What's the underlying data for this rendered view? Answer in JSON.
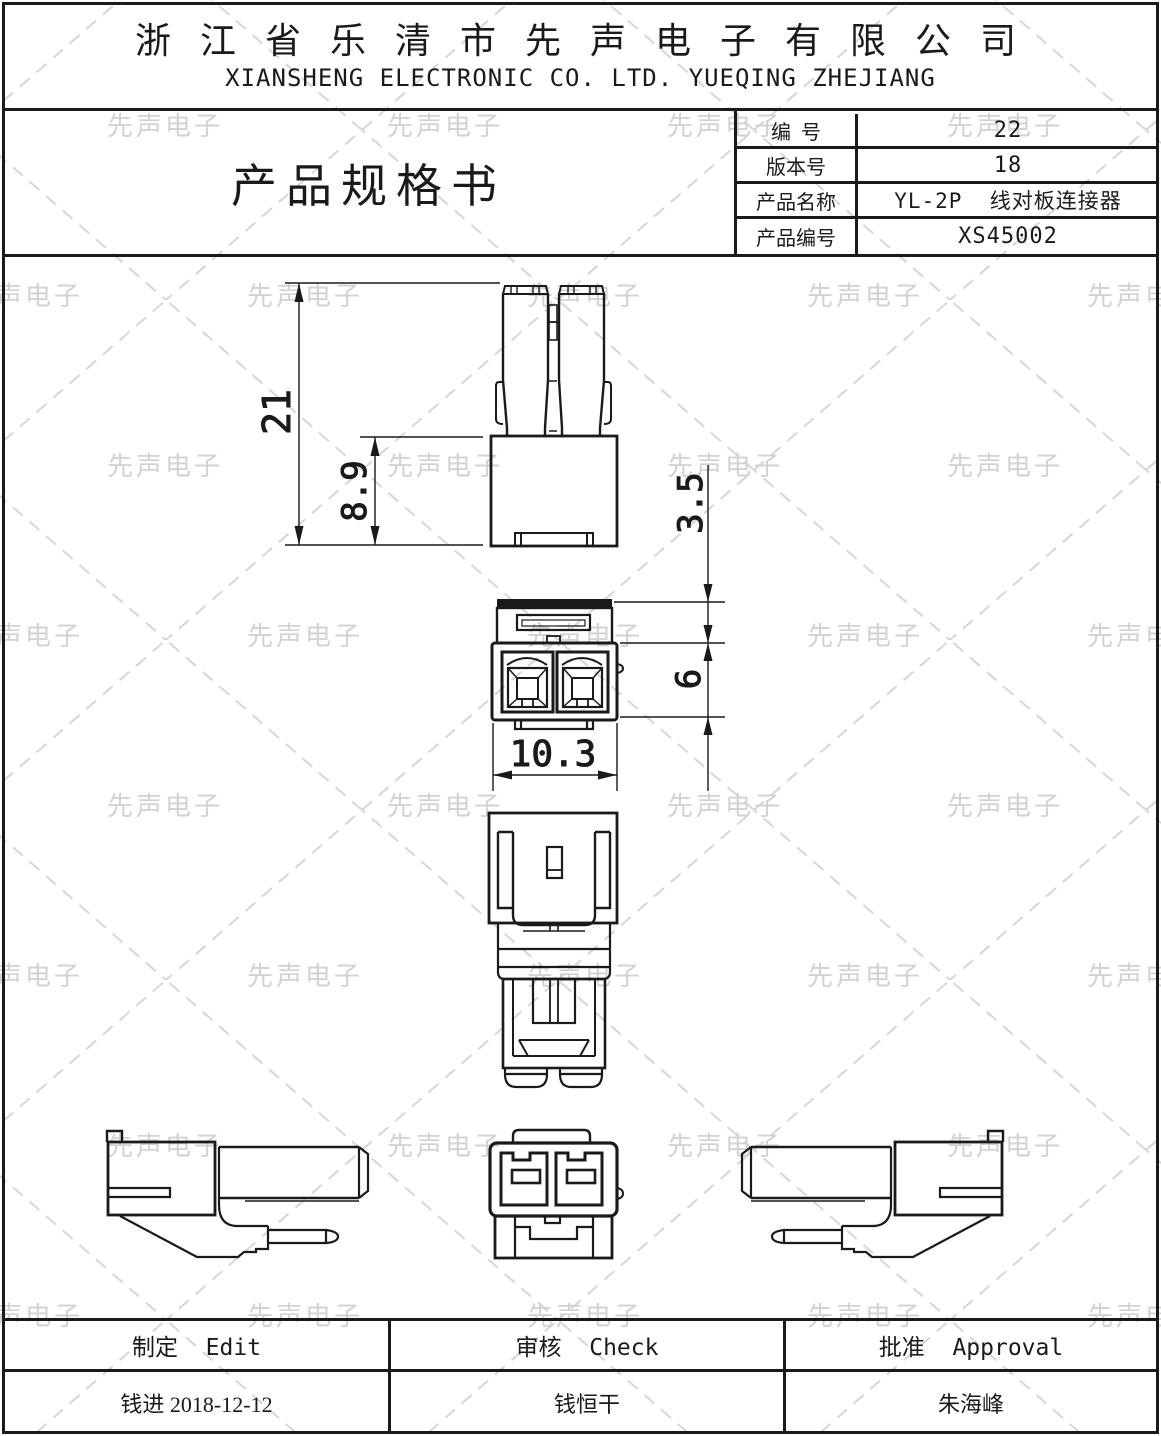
{
  "page": {
    "background": "#ffffff",
    "line_color": "#1a1a1a",
    "watermark_color": "#d2d2d6",
    "watermark_text": "先声电子"
  },
  "header": {
    "company_cn": "浙 江 省 乐 清 市 先 声 电 子 有 限 公 司",
    "company_en": "XIANSHENG ELECTRONIC CO. LTD. YUEQING ZHEJIANG"
  },
  "title_block": {
    "doc_title": "产品规格书",
    "fields": [
      {
        "label": "编  号",
        "value": "22"
      },
      {
        "label": "版本号",
        "value": "18"
      },
      {
        "label": "产品名称",
        "value": "YL-2P  线对板连接器"
      },
      {
        "label": "产品编号",
        "value": "XS45002"
      }
    ]
  },
  "drawing": {
    "dimensions": {
      "total_height": "21",
      "housing_height": "8.9",
      "flange_offset": "3.5",
      "cavity_height": "6",
      "housing_width": "10.3"
    }
  },
  "approval_table": {
    "columns": [
      {
        "header": "制定  Edit",
        "value": "钱进 2018-12-12"
      },
      {
        "header": "审核  Check",
        "value": "钱恒干"
      },
      {
        "header": "批准  Approval",
        "value": "朱海峰"
      }
    ]
  }
}
